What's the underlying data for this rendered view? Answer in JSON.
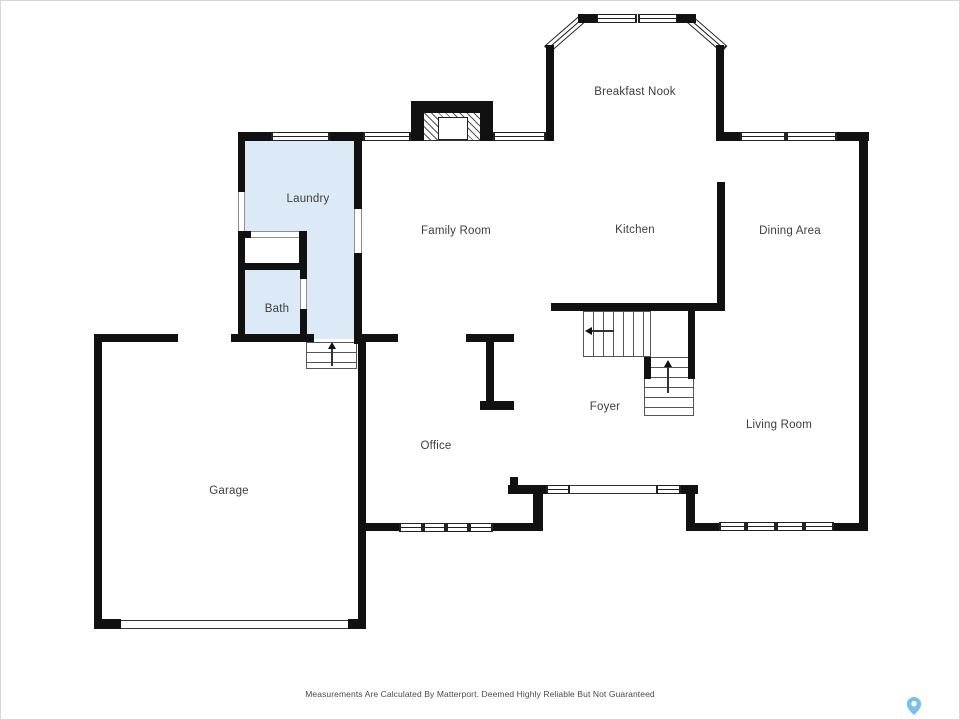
{
  "plan": {
    "title": "Main floor plan",
    "rooms": [
      {
        "id": "breakfast-nook",
        "label": "Breakfast Nook"
      },
      {
        "id": "laundry",
        "label": "Laundry"
      },
      {
        "id": "family-room",
        "label": "Family Room"
      },
      {
        "id": "kitchen",
        "label": "Kitchen"
      },
      {
        "id": "dining-area",
        "label": "Dining Area"
      },
      {
        "id": "bath",
        "label": "Bath"
      },
      {
        "id": "foyer",
        "label": "Foyer"
      },
      {
        "id": "living-room",
        "label": "Living Room"
      },
      {
        "id": "office",
        "label": "Office"
      },
      {
        "id": "garage",
        "label": "Garage"
      }
    ],
    "colors": {
      "wall": "#111111",
      "highlight_fill": "#dceaf7",
      "label_text": "#3d3d3d",
      "pin": "#7cc0e4",
      "disclaimer_text": "#4a4a4a"
    },
    "footer": {
      "disclaimer": "Measurements Are Calculated By Matterport. Deemed Highly Reliable But Not Guaranteed"
    },
    "icons": [
      {
        "name": "matterport-pin-icon"
      }
    ]
  }
}
